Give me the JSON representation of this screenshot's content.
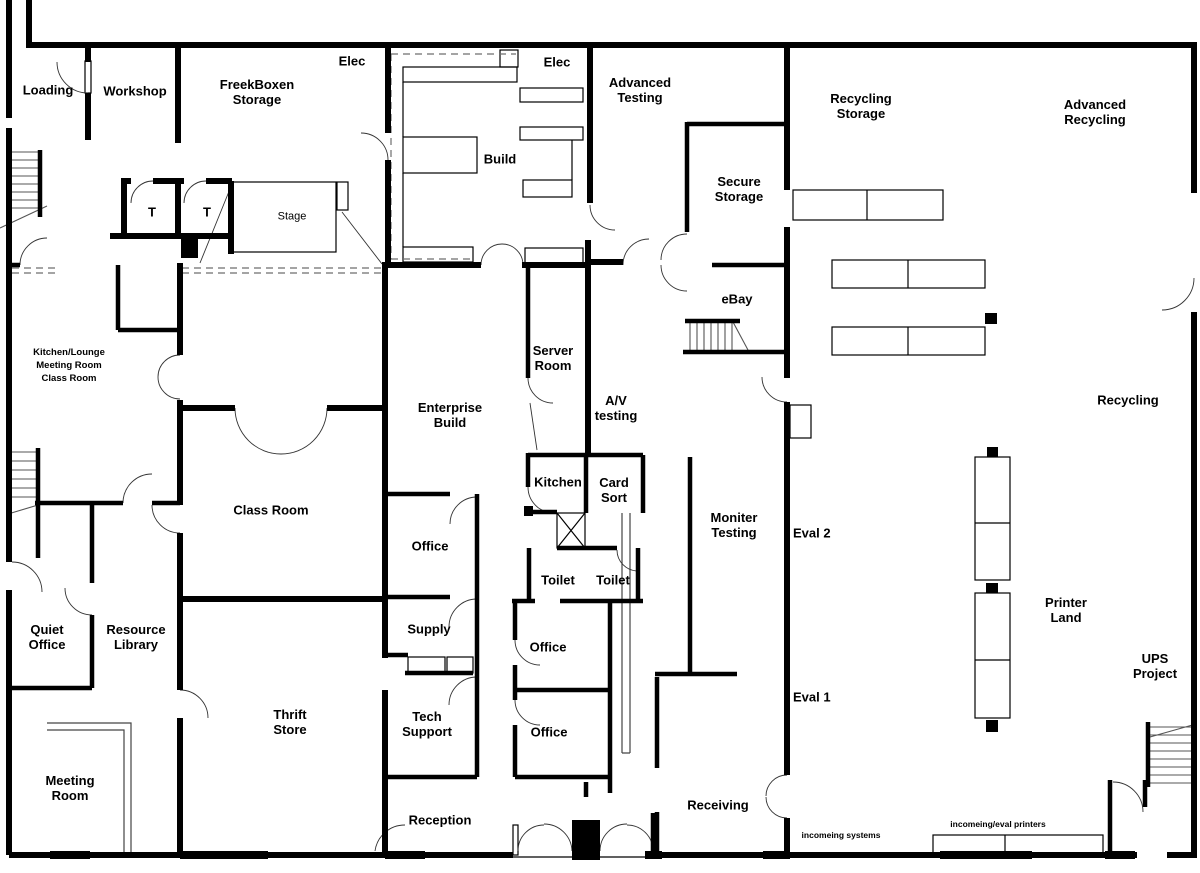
{
  "title": "Building floor plan",
  "colors": {
    "wall": "#000000",
    "dashed_line": "#6e6e6e",
    "background": "#ffffff"
  },
  "rooms": {
    "loading": "Loading",
    "workshop": "Workshop",
    "freekboxen_storage": "FreekBoxen Storage",
    "elec_nw": "Elec",
    "elec_mid": "Elec",
    "build": "Build",
    "advanced_testing": "Advanced Testing",
    "recycling_storage": "Recycling Storage",
    "advanced_recycling": "Advanced Recycling",
    "secure_storage": "Secure Storage",
    "ebay": "eBay",
    "t_room_1": "T",
    "t_room_2": "T",
    "stage": "Stage",
    "kitchen_lounge_note": "Kitchen/Lounge",
    "meeting_room_note": "Meeting Room",
    "class_room_note": "Class Room",
    "server_room": "Server Room",
    "av_testing": "A/V testing",
    "enterprise_build": "Enterprise Build",
    "class_room": "Class Room",
    "kitchen": "Kitchen",
    "card_sort": "Card Sort",
    "moniter_testing": "Moniter Testing",
    "eval_2": "Eval 2",
    "eval_1": "Eval 1",
    "recycling": "Recycling",
    "quiet_office": "Quiet Office",
    "resource_library": "Resource Library",
    "office_enterprise": "Office",
    "toilet_left": "Toilet",
    "toilet_right": "Toilet",
    "supply": "Supply",
    "office_upper": "Office",
    "office_lower": "Office",
    "printer_land": "Printer Land",
    "ups_project": "UPS Project",
    "thrift_store": "Thrift Store",
    "tech_support": "Tech Support",
    "meeting_room": "Meeting Room",
    "reception": "Reception",
    "receiving": "Receiving",
    "incomeing_systems": "incomeing systems",
    "incomeing_eval_printers": "incomeing/eval printers"
  }
}
